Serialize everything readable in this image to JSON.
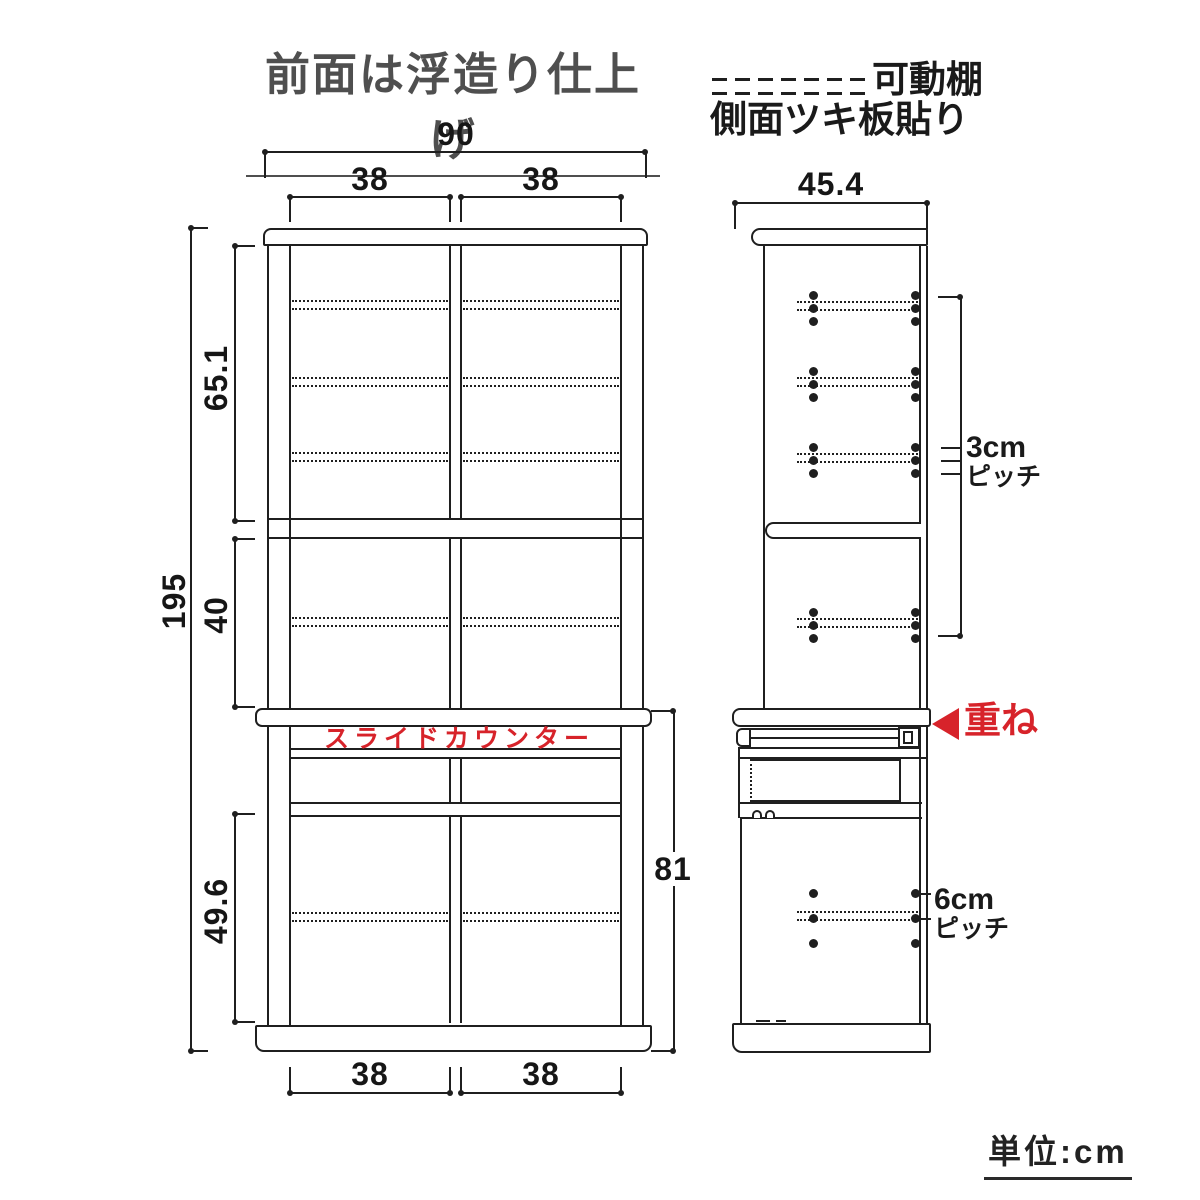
{
  "title": "前面は浮造り仕上げ",
  "legend": {
    "movable_shelf": "可動棚",
    "side_veneer": "側面ツキ板貼り"
  },
  "unit_note": "単位:cm",
  "front_view": {
    "slide_counter": "スライドカウンター",
    "dims": {
      "width_total": "90",
      "width_left_top": "38",
      "width_right_top": "38",
      "height_total": "195",
      "upper_section": "65.1",
      "middle_section": "40",
      "lower_section": "49.6",
      "lower_unit_height": "81",
      "width_left_bottom": "38",
      "width_right_bottom": "38"
    }
  },
  "side_view": {
    "stack_note": "重ね",
    "dims": {
      "depth_total": "45.4",
      "pitch_upper_value": "3cm",
      "pitch_upper_unit": "ピッチ",
      "pitch_lower_value": "6cm",
      "pitch_lower_unit": "ピッチ"
    }
  },
  "colors": {
    "line": "#1f1f1f",
    "accent_red": "#d7232a",
    "title_gray": "#4f4f4f"
  }
}
